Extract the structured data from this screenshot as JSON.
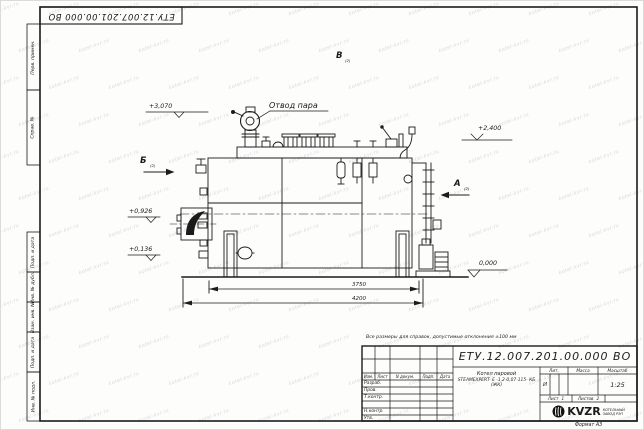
{
  "sheet": {
    "watermark": "kotel-kvr.ru",
    "note": "Все размеры для справок, допустимые отклонения ±100 мм",
    "stamp_doc_number": "ЕТУ.12.007.201.00.000  ВО",
    "format_label": "Формат А3"
  },
  "frame": {
    "side_columns_top": [
      {
        "label": "Перв. примен."
      },
      {
        "label": "Справ. №"
      }
    ],
    "side_columns_bottom": [
      {
        "label": "Подп. и дата"
      },
      {
        "label": "Инв. № дубл."
      },
      {
        "label": "Взам. инв. №"
      },
      {
        "label": "Подп. и дата"
      },
      {
        "label": "Инв. № подл."
      }
    ]
  },
  "title_block": {
    "doc_number": "ЕТУ.12.007.201.00.000  ВО",
    "header_cols": [
      "Изм.",
      "Лист",
      "N докум.",
      "Подп.",
      "Дата"
    ],
    "signature_rows": [
      "Разраб.",
      "Пров.",
      "Т.контр.",
      "",
      "Н.контр.",
      "Утв."
    ],
    "product_title": "Котел паровой",
    "product_model": "STEAMEXPERT- Е -1,2-0,07-115- КБ (ЖК)",
    "lit_label": "Лит.",
    "lit_value": "И",
    "mass_label": "Масса",
    "scale_label": "Масштаб",
    "scale_value": "1:25",
    "sheet_label": "Лист",
    "sheet_value": "1",
    "sheets_label": "Листов",
    "sheets_value": "2",
    "logo_text": "KVZR",
    "logo_caption_1": "КОТЕЛЬНЫЙ",
    "logo_caption_2": "ЗАВОД РЭП"
  },
  "drawing": {
    "steam_outlet_label": "Отвод пара",
    "elevations": {
      "e3070": "+3,070",
      "e2400": "+2,400",
      "e0926": "+0,926",
      "e0136": "+0,136",
      "e0000": "0,000"
    },
    "dimensions": {
      "inner": "3750",
      "overall": "4200"
    },
    "views": {
      "a": "А",
      "b": "Б",
      "v": "В",
      "sub": "(2)"
    }
  }
}
